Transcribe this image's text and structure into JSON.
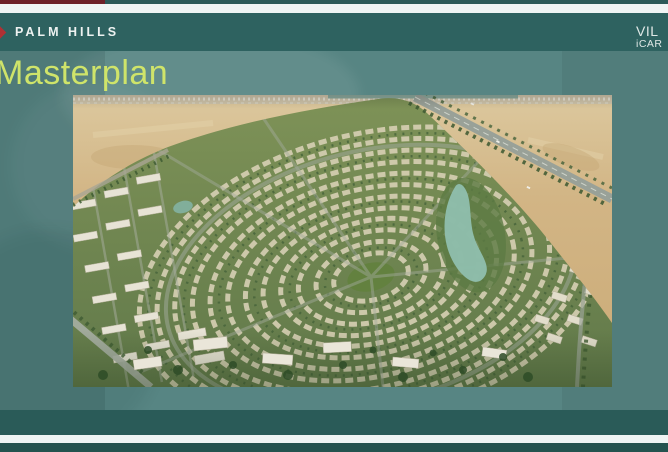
{
  "header": {
    "brand": "PALM HILLS"
  },
  "title": "Masterplan",
  "watermark": {
    "line1": "VIL",
    "line2": "iCAR"
  },
  "icons": {
    "brand": "diamond-icon"
  },
  "colors": {
    "bg-teal": "#578583",
    "band-dark": "#2e6260",
    "band-darker": "#24534f",
    "stripe-white": "#eff5f4",
    "accent-maroon": "#6d2128",
    "title-green": "#cfe46a",
    "brand-white": "#edf2f1",
    "brand-red": "#b03034",
    "watermark-white": "#dfe8e6"
  }
}
